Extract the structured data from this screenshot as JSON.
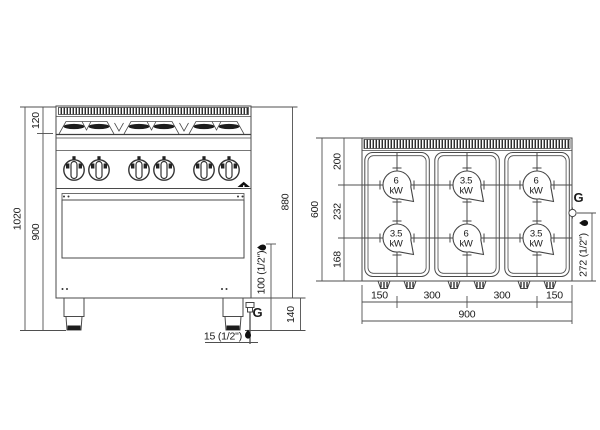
{
  "drawing_type": "gas-range-6-burner-dimension-drawing",
  "colors": {
    "line": "#4a4a4a",
    "text": "#1a1a1a",
    "dark_fill": "#1d1d1d",
    "background": "#ffffff"
  },
  "front_view": {
    "height_total": "1020",
    "height_top_section": "120",
    "height_body": "900",
    "height_right": "880",
    "gas_inlet_height": "100 (1/2\")",
    "leg_height": "140",
    "gas_bottom_offset": "15 (1/2\")",
    "gas_label": "G"
  },
  "top_view": {
    "depth_total": "600",
    "depth_back": "200",
    "depth_mid": "232",
    "depth_front": "168",
    "width_total": "900",
    "width_segs": [
      "150",
      "300",
      "300",
      "150"
    ],
    "gas_offset": "272 (1/2\")",
    "gas_label": "G",
    "burners": [
      {
        "power": "6",
        "unit": "kW"
      },
      {
        "power": "3.5",
        "unit": "kW"
      },
      {
        "power": "6",
        "unit": "kW"
      },
      {
        "power": "3.5",
        "unit": "kW"
      },
      {
        "power": "6",
        "unit": "kW"
      },
      {
        "power": "3.5",
        "unit": "kW"
      }
    ]
  }
}
